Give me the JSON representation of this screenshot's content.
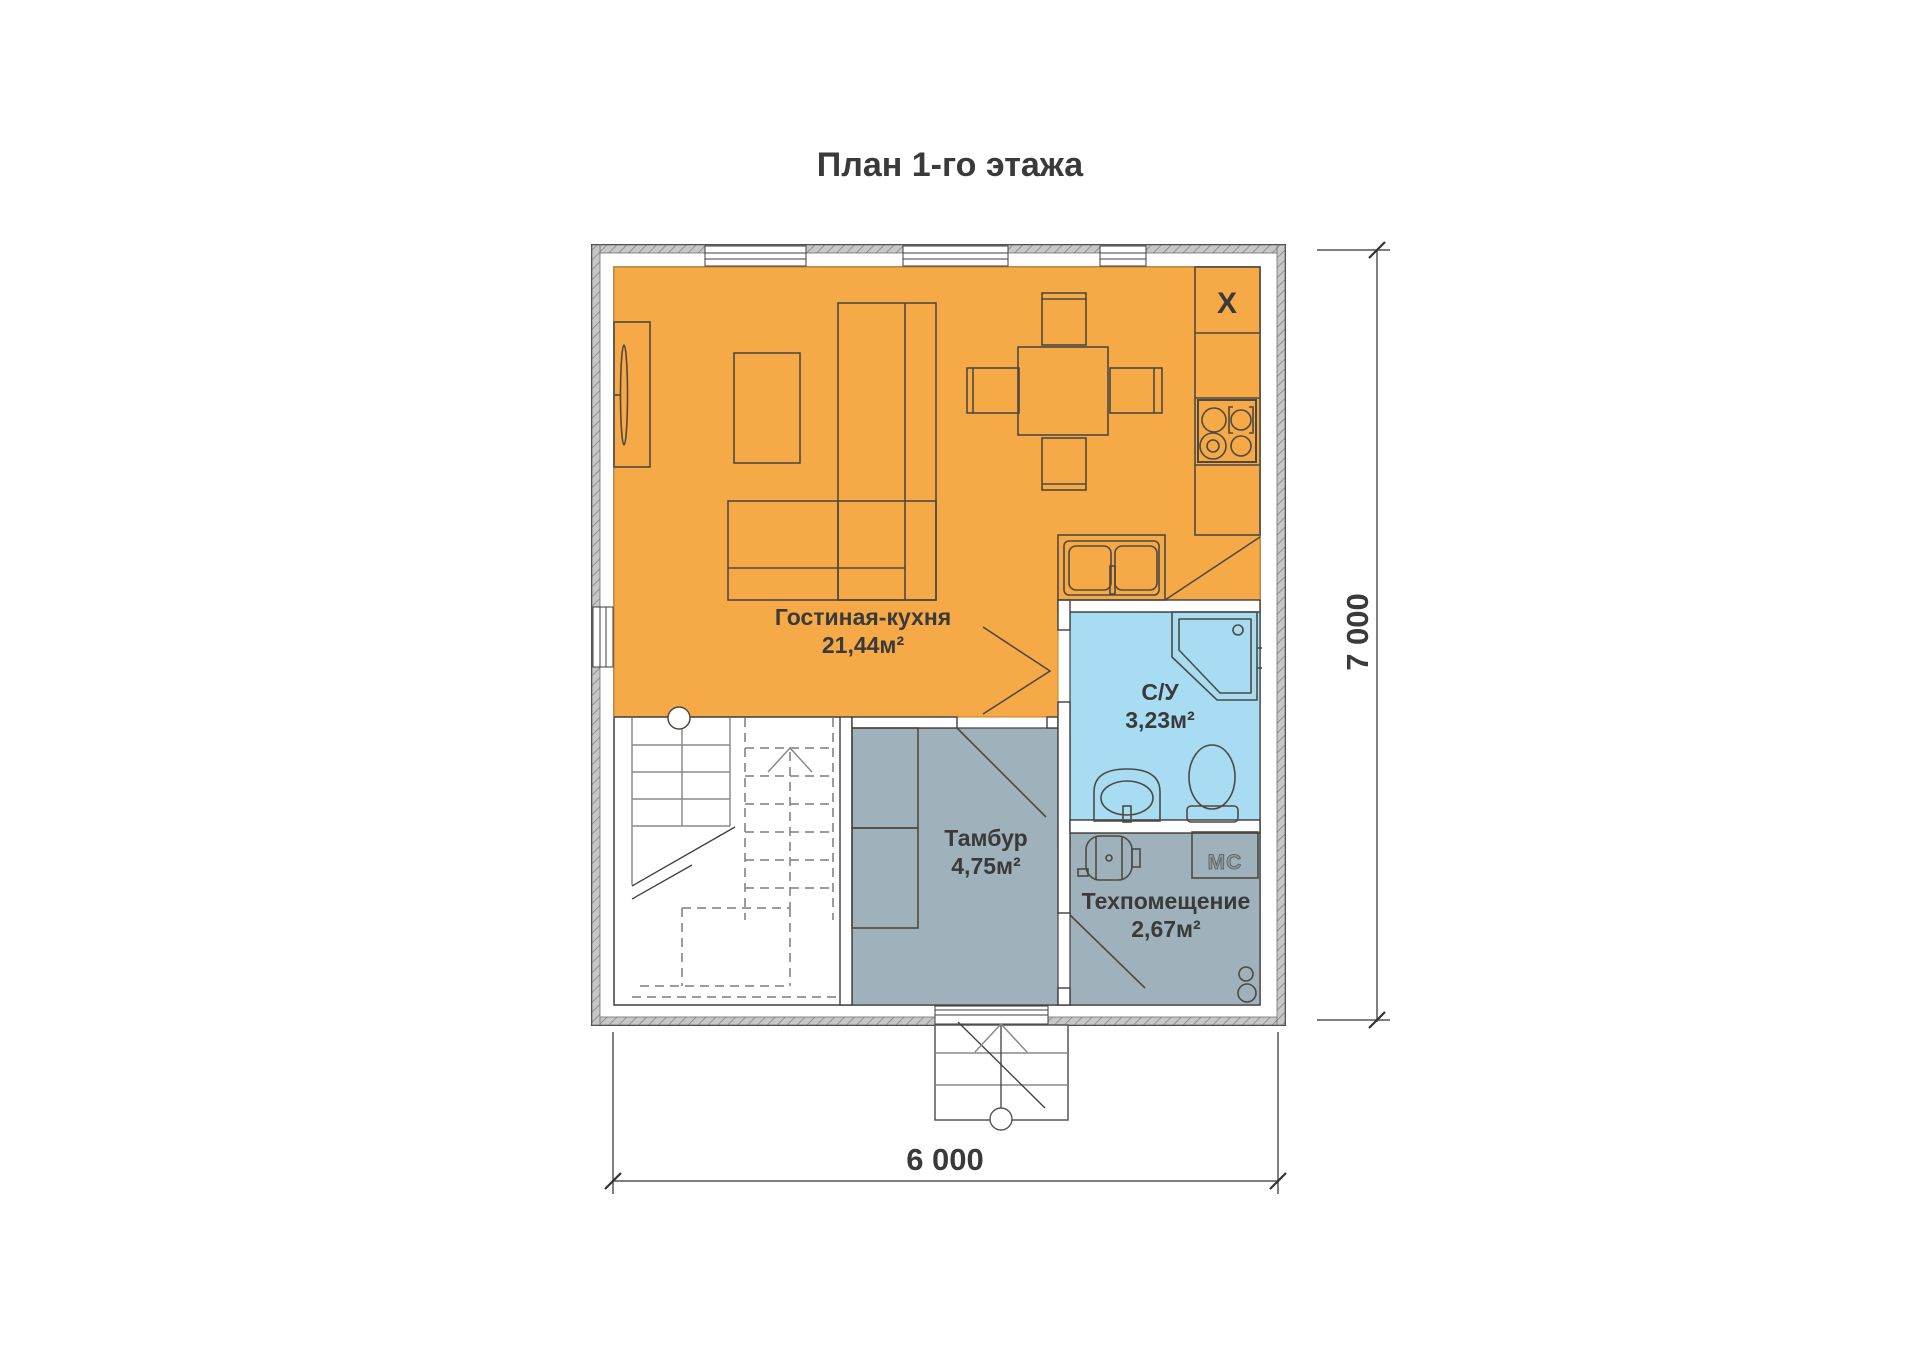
{
  "title": "План 1-го этажа",
  "rooms": {
    "living": {
      "name": "Гостиная-кухня",
      "area": "21,44м²"
    },
    "bathroom": {
      "name": "С/У",
      "area": "3,23м²"
    },
    "vestibule": {
      "name": "Тамбур",
      "area": "4,75м²"
    },
    "tech": {
      "name": "Техпомещение",
      "area": "2,67м²"
    }
  },
  "appliances": {
    "fridge_marker": "X",
    "washing_machine": "МС"
  },
  "dimensions": {
    "width": "6 000",
    "height": "7 000"
  },
  "colors": {
    "living": "#F5A947",
    "bathroom": "#A8DCF2",
    "service": "#9FB1BA",
    "wall-line": "#3E3E3E",
    "text": "#3A3A3A"
  }
}
